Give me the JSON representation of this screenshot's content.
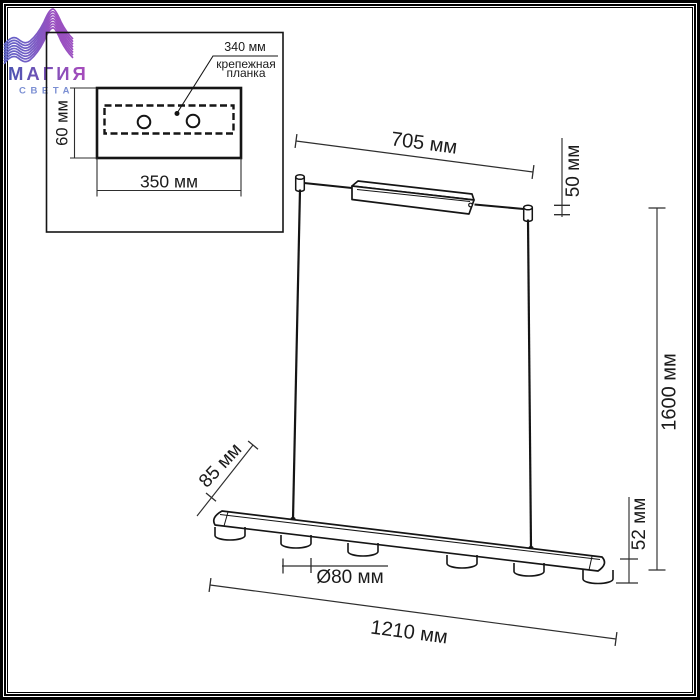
{
  "logo": {
    "brand": "МАГИЯ",
    "subtitle": "СВЕТА",
    "wave_color_start": "#5566C8",
    "wave_color_end": "#AE49BE",
    "brand_color_start": "#4B55B2",
    "brand_color_end": "#A44CBC",
    "subtitle_color": "#7B8FD3"
  },
  "inset": {
    "bracket_length_label": "340 мм",
    "bracket_name_line1": "крепежная",
    "bracket_name_line2": "планка",
    "plate_height_label": "60 мм",
    "plate_width_label": "350 мм",
    "hole_count": 2
  },
  "fixture_dimensions": {
    "canopy_length": "705 мм",
    "canopy_height": "50 мм",
    "suspension_height": "1600 мм",
    "bar_depth": "85 мм",
    "bar_end_height": "52 мм",
    "lamp_diameter": "Ø80 мм",
    "bar_length": "1210 мм",
    "lamp_count": 6
  },
  "colors": {
    "line": "#1a1a1a",
    "dimension_line": "#2e2e2e",
    "background": "#ffffff"
  }
}
